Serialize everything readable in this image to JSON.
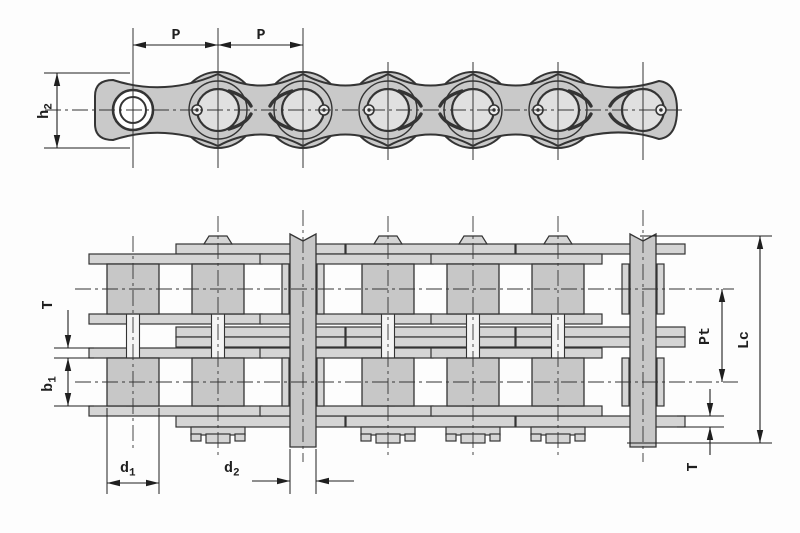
{
  "drawing": {
    "bg": "#fdfdfd",
    "line": "#343434",
    "plate_fill": "#c9c9c9",
    "roller_fill": "#e0e0e0",
    "bar_fill": "#d5d5d5",
    "block_fill": "#c7c7c7",
    "dim_color": "#1f1f1f"
  },
  "side_view": {
    "pitch_label_1": "P",
    "pitch_label_2": "P",
    "plate_height_label": {
      "base": "h",
      "sub": "2"
    }
  },
  "plan_view": {
    "plate_thickness_label_left": "T",
    "inner_width_label": {
      "base": "b",
      "sub": "1"
    },
    "roller_diameter_label": {
      "base": "d",
      "sub": "1"
    },
    "pin_diameter_label": {
      "base": "d",
      "sub": "2"
    },
    "transverse_pitch_label": "Pt",
    "overall_pin_length_label": "Lc",
    "plate_thickness_label_right": "T"
  }
}
